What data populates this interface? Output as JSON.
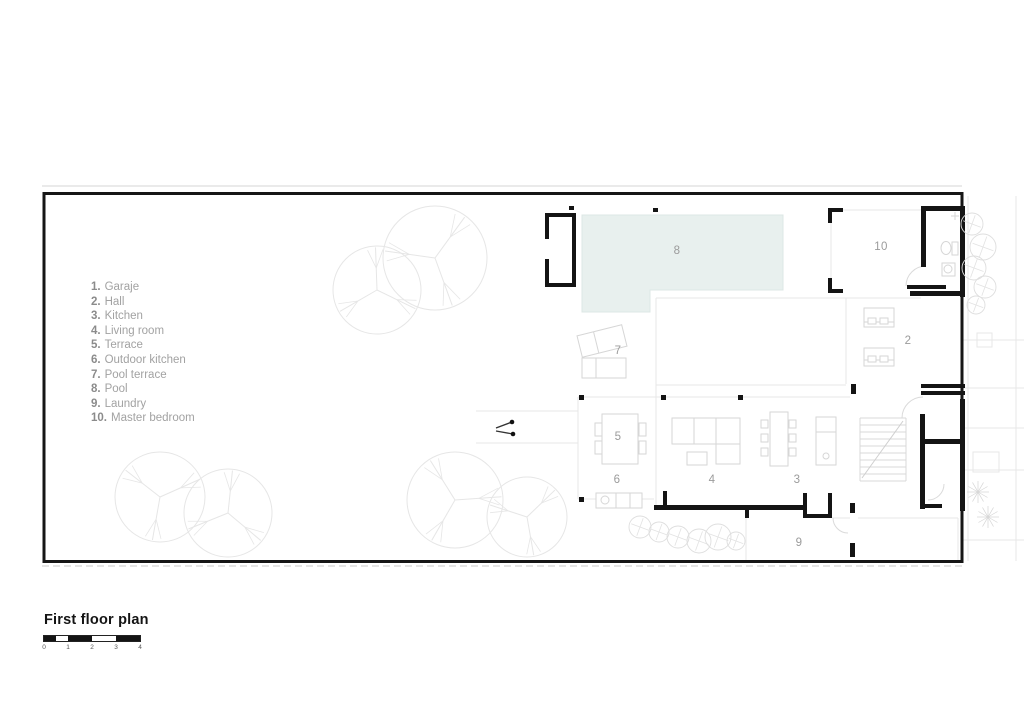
{
  "colors": {
    "pool_fill": "#e8f0ee",
    "wall": "#141414",
    "label_text": "#9b9b9b",
    "tree_line": "#e6e6e6"
  },
  "legend": {
    "items": [
      {
        "num": "1.",
        "name": "Garaje"
      },
      {
        "num": "2.",
        "name": "Hall"
      },
      {
        "num": "3.",
        "name": "Kitchen"
      },
      {
        "num": "4.",
        "name": "Living room"
      },
      {
        "num": "5.",
        "name": "Terrace"
      },
      {
        "num": "6.",
        "name": "Outdoor kitchen"
      },
      {
        "num": "7.",
        "name": "Pool terrace"
      },
      {
        "num": "8.",
        "name": "Pool"
      },
      {
        "num": "9.",
        "name": "Laundry"
      },
      {
        "num": "10.",
        "name": "Master bedroom"
      }
    ]
  },
  "plan": {
    "room_labels": {
      "r2": "2",
      "r3": "3",
      "r4": "4",
      "r5": "5",
      "r6": "6",
      "r7": "7",
      "r8": "8",
      "r9": "9",
      "r10": "10"
    }
  },
  "title_block": {
    "title": "First floor plan",
    "scale_labels": [
      "0",
      "1",
      "2",
      "3",
      "4"
    ]
  }
}
